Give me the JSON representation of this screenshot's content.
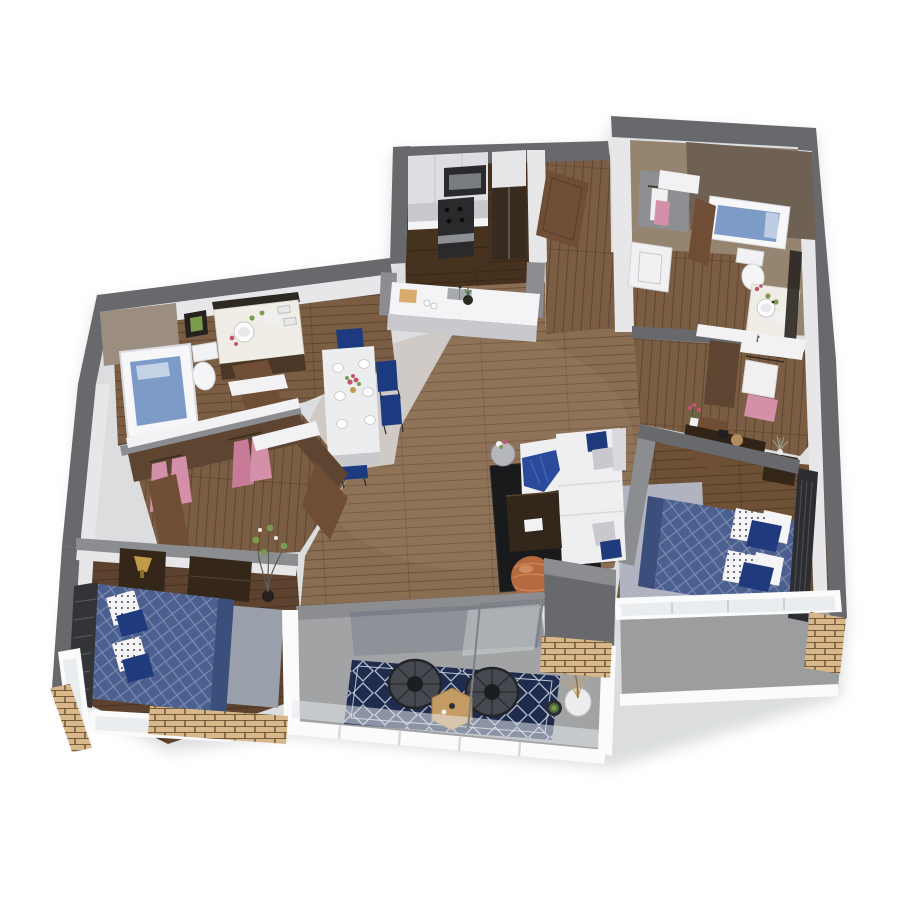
{
  "scene": {
    "type": "3d-floor-plan",
    "description": "Isometric 3D rendered floor plan of a two-bedroom, two-bathroom apartment with open kitchen, dining and living areas, walk-in closets and a large balcony, on a white background",
    "rooms": [
      {
        "id": "kitchen",
        "objects": [
          "upper-cabinets",
          "microwave",
          "oven-range",
          "refrigerator",
          "lower-cabinets",
          "peninsula-counter",
          "sink",
          "cutting-board",
          "mugs",
          "vase"
        ]
      },
      {
        "id": "entry-hall",
        "objects": [
          "entry-door"
        ]
      },
      {
        "id": "bathroom-right",
        "objects": [
          "soaking-tub",
          "toilet",
          "vessel-sink-vanity",
          "mirror",
          "washer",
          "linen-closet-clothes"
        ]
      },
      {
        "id": "hall-closets-right",
        "objects": [
          "hanging-clothes-white",
          "hanging-clothes-pink",
          "closet-doors"
        ]
      },
      {
        "id": "master-bedroom",
        "objects": [
          "double-bed-blue-quilt",
          "polka-dot-pillows",
          "navy-pillows",
          "metal-headboard",
          "nightstand",
          "console-dresser",
          "area-rug",
          "closet",
          "window-wall"
        ]
      },
      {
        "id": "living-room",
        "objects": [
          "white-sectional-sofa",
          "navy-pillows",
          "gray-pillows",
          "blue-throw",
          "coffee-table",
          "laptop",
          "black-area-rug",
          "copper-pouf",
          "round-side-table",
          "flowers"
        ]
      },
      {
        "id": "dining-area",
        "objects": [
          "white-dining-table",
          "six-place-settings",
          "navy-chairs",
          "flower-centerpiece"
        ]
      },
      {
        "id": "bathroom-left",
        "objects": [
          "bathtub",
          "toilet",
          "marble-vanity",
          "vessel-sink",
          "mirror",
          "framed-art",
          "towels",
          "flowers"
        ]
      },
      {
        "id": "walk-in-closet-left",
        "objects": [
          "pink-dresses",
          "closet-doors",
          "white-shelf-caps"
        ]
      },
      {
        "id": "bedroom-left",
        "objects": [
          "double-bed-blue-quilt",
          "polka-dot-pillows",
          "metal-headboard",
          "nightstand",
          "gold-lamp",
          "dresser",
          "gray-area-rug",
          "flower-branches",
          "window-wall"
        ]
      },
      {
        "id": "balcony",
        "objects": [
          "navy-trellis-rug",
          "wire-saucer-chairs",
          "hexagonal-wood-table",
          "potted-grass-plant",
          "succulent-pot",
          "glass-railing",
          "brick-planters",
          "sliding-glass-door"
        ]
      }
    ]
  },
  "colors": {
    "background": "#ffffff",
    "wall_outer": "#67696d",
    "wall_outer_dark": "#595b5f",
    "wall_outer_light": "#8b8d91",
    "wall_top_white": "#f2f2f4",
    "wall_face_white": "#e7e7ea",
    "wall_shadow": "#c9c9cd",
    "wood_main": "#8a6e54",
    "wood_kitchen": "#46311f",
    "wood_corridor": "#7a5d43",
    "wood_bedroom_left": "#5d422f",
    "wood_bedroom_right": "#6e5037",
    "tile_bath_right": "#95846f",
    "tile_bath_wall": "#6e6053",
    "tile_bath_left": "#9b8d80",
    "balcony_floor": "#a1a3a5",
    "rug_black": "#191a1c",
    "rug_gray_blue": "#b4b9c7",
    "rug_gray": "#99a0ac",
    "rug_navy": "#202c4e",
    "bed_blue": "#4c6090",
    "bed_blue_dark": "#3b4e7c",
    "pillow_navy": "#203b7d",
    "pillow_white": "#f5f5f7",
    "sofa_white": "#efeff1",
    "sofa_shadow": "#d8d9dc",
    "throw_blue": "#2a4a9c",
    "table_white": "#ebedee",
    "chair_navy": "#1c3a7f",
    "wood_furniture_dark": "#342618",
    "counter_white": "#f4f4f6",
    "cabinet_light": "#dddee1",
    "cabinet_dark": "#45321f",
    "appliance_dark": "#2a2a2d",
    "steel": "#a6aaae",
    "door_brown": "#6f4e35",
    "closet_brown": "#5d4532",
    "clothes_pink": "#d48fa9",
    "clothes_white": "#f1efef",
    "water_blue": "#7d9bc7",
    "tub_white": "#f7f7f9",
    "pouf_copper": "#b5693f",
    "hex_table_wood": "#c49b63",
    "plant_green": "#7a9a4e",
    "plant_dark": "#51703f",
    "brick_tan": "#d8b88b",
    "metal_dark": "#2d2e31",
    "glass_pale": "#e6eaec",
    "frame_white": "#fbfbfc",
    "lamp_gold": "#c29b4a",
    "flower_red": "#c0566d",
    "marble_white": "#efede6"
  }
}
